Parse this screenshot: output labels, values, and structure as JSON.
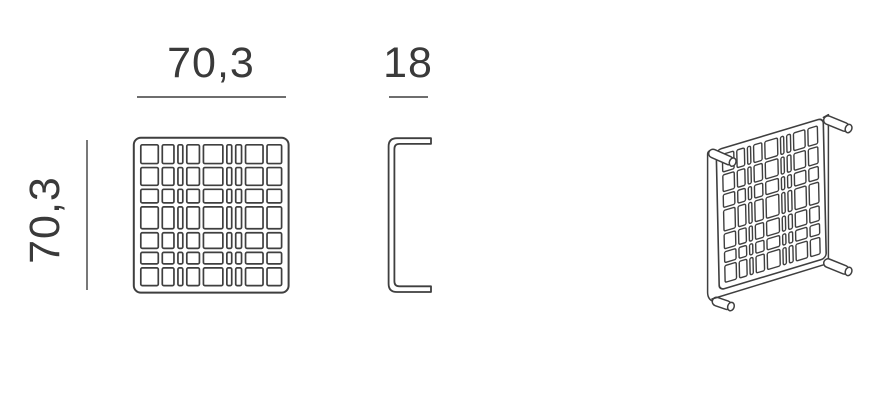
{
  "page": {
    "background": "#ffffff"
  },
  "drawing": {
    "line_color": "#3f3f3f",
    "text_color": "#3a3a3a",
    "dimensions": {
      "front_width": "70,3",
      "front_height": "70,3",
      "side_depth": "18"
    },
    "panel_pattern": {
      "columns": 9,
      "rows": 7,
      "col_weights": [
        18,
        12,
        5,
        13,
        20,
        5,
        6,
        18,
        15
      ],
      "row_weights": [
        18,
        17,
        13,
        21,
        15,
        11,
        17
      ],
      "gap": 4,
      "padding": 7
    }
  }
}
